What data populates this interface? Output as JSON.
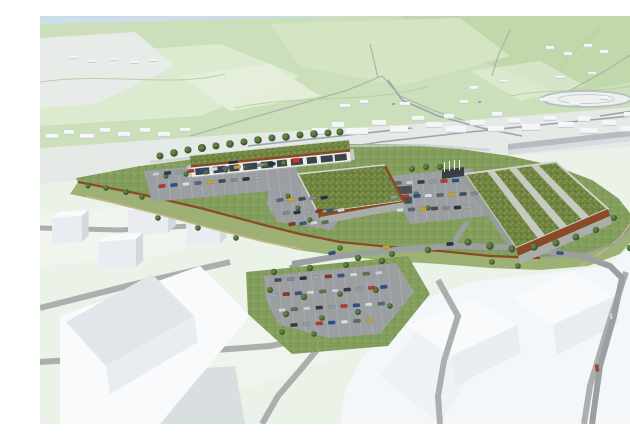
{
  "scene": {
    "title": "Aerial 3D architectural visualisation of a planned retail park with green-roofed buildings, parking lots and access roads, set in a white massing model of the surrounding town with pale green hills behind",
    "elements": [
      "sky",
      "distant-hills",
      "massing-model-town",
      "racetrack-oval",
      "retail-building-long",
      "retail-building-center",
      "retail-building-large",
      "green-roofs-with-gravel-strips",
      "corten-retaining-walls",
      "parking-lots-with-cars",
      "access-roads",
      "footpaths",
      "street-trees",
      "foreground-parking-lot",
      "white-context-blocks"
    ]
  },
  "palette": {
    "sky": "#c9dbea",
    "skyLow": "#eef3f4",
    "farHill": "#cbdfba",
    "farHillLight": "#dcead0",
    "farHillDark": "#c0d8ab",
    "hillHighlight": "#d5e5c4",
    "fieldPatch": "#e5eedb",
    "distantWhite": "#e8ece9",
    "valley": "#e6eae6",
    "townBlock": "#f4f6f8",
    "townBlockSide": "#c9d0d7",
    "townRoad": "#9da5ac",
    "viaduct": "#b6bcc1",
    "water": "#79aed0",
    "fgGround": "#ebf2e8",
    "fgGroundLight": "#f2f7f0",
    "fgRoad": "#abafae",
    "whiteZone": "#f4f7f9",
    "massingTop": "#f8fafb",
    "massingFront": "#e9edf1",
    "massingSide": "#d2d9df",
    "slabGray": "#d9dee1",
    "siteGrass": "#849e5e",
    "slopeGrass": "#9eb175",
    "greenRoof": "#6f8440",
    "gravel": "#c7cabf",
    "parapet": "#d8dbd5",
    "corten": "#8a4a26",
    "wallGray": "#a9aeaa",
    "wallLight": "#c3c7c2",
    "facade": "#eceeeb",
    "glazing": "#39434c",
    "signRed": "#c4372a",
    "signDark": "#23282c",
    "asphalt": "#9b9fa2",
    "path": "#c6b48c",
    "treeGreen": "#5d8044",
    "treeDark": "#40592e",
    "canopyDark": "#3a3f43",
    "shelterDark": "#4a5054"
  },
  "town": {
    "blocks": [
      [
        272,
        112,
        16,
        7
      ],
      [
        292,
        106,
        12,
        6
      ],
      [
        306,
        112,
        22,
        7
      ],
      [
        332,
        104,
        14,
        6
      ],
      [
        350,
        110,
        18,
        7
      ],
      [
        372,
        100,
        12,
        5
      ],
      [
        386,
        106,
        16,
        6
      ],
      [
        404,
        98,
        10,
        5
      ],
      [
        406,
        110,
        20,
        7
      ],
      [
        430,
        104,
        14,
        6
      ],
      [
        448,
        110,
        16,
        6
      ],
      [
        452,
        96,
        10,
        5
      ],
      [
        468,
        102,
        12,
        6
      ],
      [
        482,
        108,
        18,
        7
      ],
      [
        504,
        100,
        12,
        5
      ],
      [
        518,
        106,
        16,
        6
      ],
      [
        538,
        100,
        12,
        6
      ],
      [
        540,
        112,
        18,
        6
      ],
      [
        562,
        104,
        14,
        6
      ],
      [
        580,
        110,
        16,
        6
      ],
      [
        584,
        96,
        10,
        5
      ],
      [
        602,
        104,
        12,
        6
      ],
      [
        616,
        110,
        12,
        6
      ],
      [
        6,
        118,
        12,
        5
      ],
      [
        24,
        114,
        10,
        5
      ],
      [
        40,
        118,
        14,
        5
      ],
      [
        60,
        112,
        10,
        5
      ],
      [
        78,
        116,
        12,
        5
      ],
      [
        100,
        112,
        10,
        5
      ],
      [
        118,
        116,
        12,
        5
      ],
      [
        140,
        112,
        10,
        4
      ],
      [
        300,
        88,
        10,
        4
      ],
      [
        320,
        84,
        8,
        4
      ],
      [
        360,
        86,
        10,
        4
      ],
      [
        420,
        84,
        8,
        4
      ],
      [
        500,
        82,
        8,
        4
      ],
      [
        530,
        86,
        10,
        4
      ],
      [
        560,
        80,
        8,
        4
      ],
      [
        600,
        84,
        10,
        4
      ],
      [
        430,
        70,
        8,
        4
      ],
      [
        460,
        64,
        8,
        3
      ],
      [
        516,
        60,
        8,
        3
      ],
      [
        548,
        56,
        8,
        3
      ],
      [
        506,
        30,
        8,
        4
      ],
      [
        524,
        36,
        8,
        4
      ],
      [
        544,
        28,
        8,
        4
      ],
      [
        560,
        34,
        8,
        4
      ],
      [
        30,
        40,
        8,
        3
      ],
      [
        48,
        44,
        8,
        3
      ],
      [
        70,
        42,
        8,
        3
      ],
      [
        90,
        45,
        8,
        3
      ],
      [
        110,
        43,
        8,
        3
      ]
    ]
  },
  "massing": {
    "cubes": [
      [
        12,
        202,
        30,
        26,
        12
      ],
      [
        88,
        194,
        40,
        26,
        14
      ],
      [
        58,
        226,
        38,
        28,
        13
      ],
      [
        146,
        206,
        34,
        24,
        12
      ],
      [
        600,
        222,
        22,
        16,
        8
      ],
      [
        596,
        252,
        18,
        12,
        7
      ]
    ]
  },
  "trees": {
    "points": [
      [
        120,
        140,
        3.5
      ],
      [
        134,
        137,
        3.8
      ],
      [
        148,
        134,
        3.5
      ],
      [
        162,
        132,
        4
      ],
      [
        176,
        130,
        3.5
      ],
      [
        190,
        128,
        3.8
      ],
      [
        204,
        126,
        3.5
      ],
      [
        218,
        124,
        3.8
      ],
      [
        232,
        122,
        3.5
      ],
      [
        246,
        121,
        3.8
      ],
      [
        260,
        119,
        3.5
      ],
      [
        274,
        118,
        3.8
      ],
      [
        288,
        117,
        3.5
      ],
      [
        300,
        116,
        3.5
      ],
      [
        126,
        160,
        2.6
      ],
      [
        146,
        158,
        2.6
      ],
      [
        166,
        156,
        2.6
      ],
      [
        186,
        154,
        2.6
      ],
      [
        206,
        151,
        2.6
      ],
      [
        226,
        149,
        2.6
      ],
      [
        244,
        147,
        2.6
      ],
      [
        66,
        172,
        2.8
      ],
      [
        86,
        176,
        3
      ],
      [
        102,
        181,
        2.8
      ],
      [
        48,
        170,
        2.4
      ],
      [
        248,
        180,
        2.6
      ],
      [
        258,
        192,
        2.6
      ],
      [
        270,
        204,
        2.6
      ],
      [
        372,
        153,
        3
      ],
      [
        386,
        151,
        3
      ],
      [
        400,
        151,
        3
      ],
      [
        376,
        178,
        2.6
      ],
      [
        388,
        192,
        2.6
      ],
      [
        428,
        226,
        3.6
      ],
      [
        450,
        230,
        3.8
      ],
      [
        472,
        233,
        3.6
      ],
      [
        494,
        231,
        3.8
      ],
      [
        516,
        227,
        3.6
      ],
      [
        536,
        221,
        3.4
      ],
      [
        556,
        214,
        3.2
      ],
      [
        574,
        202,
        3
      ],
      [
        590,
        232,
        3.2
      ],
      [
        604,
        236,
        3.6
      ],
      [
        616,
        228,
        3.8
      ],
      [
        624,
        246,
        4
      ],
      [
        318,
        242,
        3.2
      ],
      [
        352,
        238,
        3
      ],
      [
        388,
        234,
        3.2
      ],
      [
        300,
        232,
        2.8
      ],
      [
        118,
        202,
        2.8
      ],
      [
        158,
        212,
        2.8
      ],
      [
        196,
        222,
        2.8
      ],
      [
        234,
        256,
        3.2
      ],
      [
        270,
        252,
        3.2
      ],
      [
        306,
        249,
        3
      ],
      [
        342,
        245,
        3.2
      ],
      [
        230,
        274,
        3
      ],
      [
        264,
        281,
        3.2
      ],
      [
        300,
        278,
        2.8
      ],
      [
        336,
        274,
        3
      ],
      [
        246,
        298,
        3.2
      ],
      [
        282,
        302,
        2.8
      ],
      [
        318,
        296,
        3
      ],
      [
        350,
        290,
        2.8
      ],
      [
        242,
        316,
        2.8
      ],
      [
        274,
        318,
        2.8
      ],
      [
        452,
        246,
        2.8
      ],
      [
        478,
        250,
        2.8
      ]
    ]
  },
  "cars": {
    "colors": [
      "#c9cdd1",
      "#343a41",
      "#8d99a5",
      "#b23b2e",
      "#2c4f8c",
      "#dadde0",
      "#5b6572",
      "#c9a12b",
      "#474c52",
      "#7e8893",
      "#273340",
      "#a0a7ae",
      "#87352b",
      "#3a557b",
      "#d2d5d8",
      "#5e7050"
    ],
    "rows": [
      {
        "x": 116,
        "y": 158,
        "n": 11,
        "dx": 11.6,
        "dy": -1.0,
        "rot": -7
      },
      {
        "x": 122,
        "y": 170,
        "n": 9,
        "dx": 12,
        "dy": -1.0,
        "rot": -7
      },
      {
        "x": 240,
        "y": 184,
        "n": 5,
        "dx": 11,
        "dy": -0.6,
        "rot": -9
      },
      {
        "x": 246,
        "y": 197,
        "n": 6,
        "dx": 11,
        "dy": -0.6,
        "rot": -9
      },
      {
        "x": 252,
        "y": 208,
        "n": 4,
        "dx": 11,
        "dy": -0.6,
        "rot": -9
      },
      {
        "x": 358,
        "y": 167,
        "n": 6,
        "dx": 11.5,
        "dy": -0.5,
        "rot": -5
      },
      {
        "x": 354,
        "y": 181,
        "n": 8,
        "dx": 11.5,
        "dy": -0.5,
        "rot": -5
      },
      {
        "x": 360,
        "y": 194,
        "n": 7,
        "dx": 11.5,
        "dy": -0.5,
        "rot": -5
      },
      {
        "x": 238,
        "y": 264,
        "n": 9,
        "dx": 12.6,
        "dy": -0.9,
        "rot": -5
      },
      {
        "x": 234,
        "y": 279,
        "n": 10,
        "dx": 12.2,
        "dy": -0.9,
        "rot": -5
      },
      {
        "x": 242,
        "y": 294,
        "n": 9,
        "dx": 12.4,
        "dy": -0.8,
        "rot": -4
      },
      {
        "x": 254,
        "y": 309,
        "n": 7,
        "dx": 12.6,
        "dy": -0.8,
        "rot": -3
      },
      {
        "x": 292,
        "y": 237,
        "n": 1,
        "dx": 0,
        "dy": 0,
        "rot": -12
      },
      {
        "x": 346,
        "y": 231,
        "n": 1,
        "dx": 0,
        "dy": 0,
        "rot": -8
      },
      {
        "x": 410,
        "y": 228,
        "n": 1,
        "dx": 0,
        "dy": 0,
        "rot": -5
      },
      {
        "x": 520,
        "y": 237,
        "n": 1,
        "dx": 0,
        "dy": 0,
        "rot": 4
      },
      {
        "x": 571,
        "y": 300,
        "n": 1,
        "dx": 0,
        "dy": 0,
        "rot": 78
      },
      {
        "x": 557,
        "y": 352,
        "n": 1,
        "dx": 0,
        "dy": 0,
        "rot": 82
      }
    ]
  }
}
